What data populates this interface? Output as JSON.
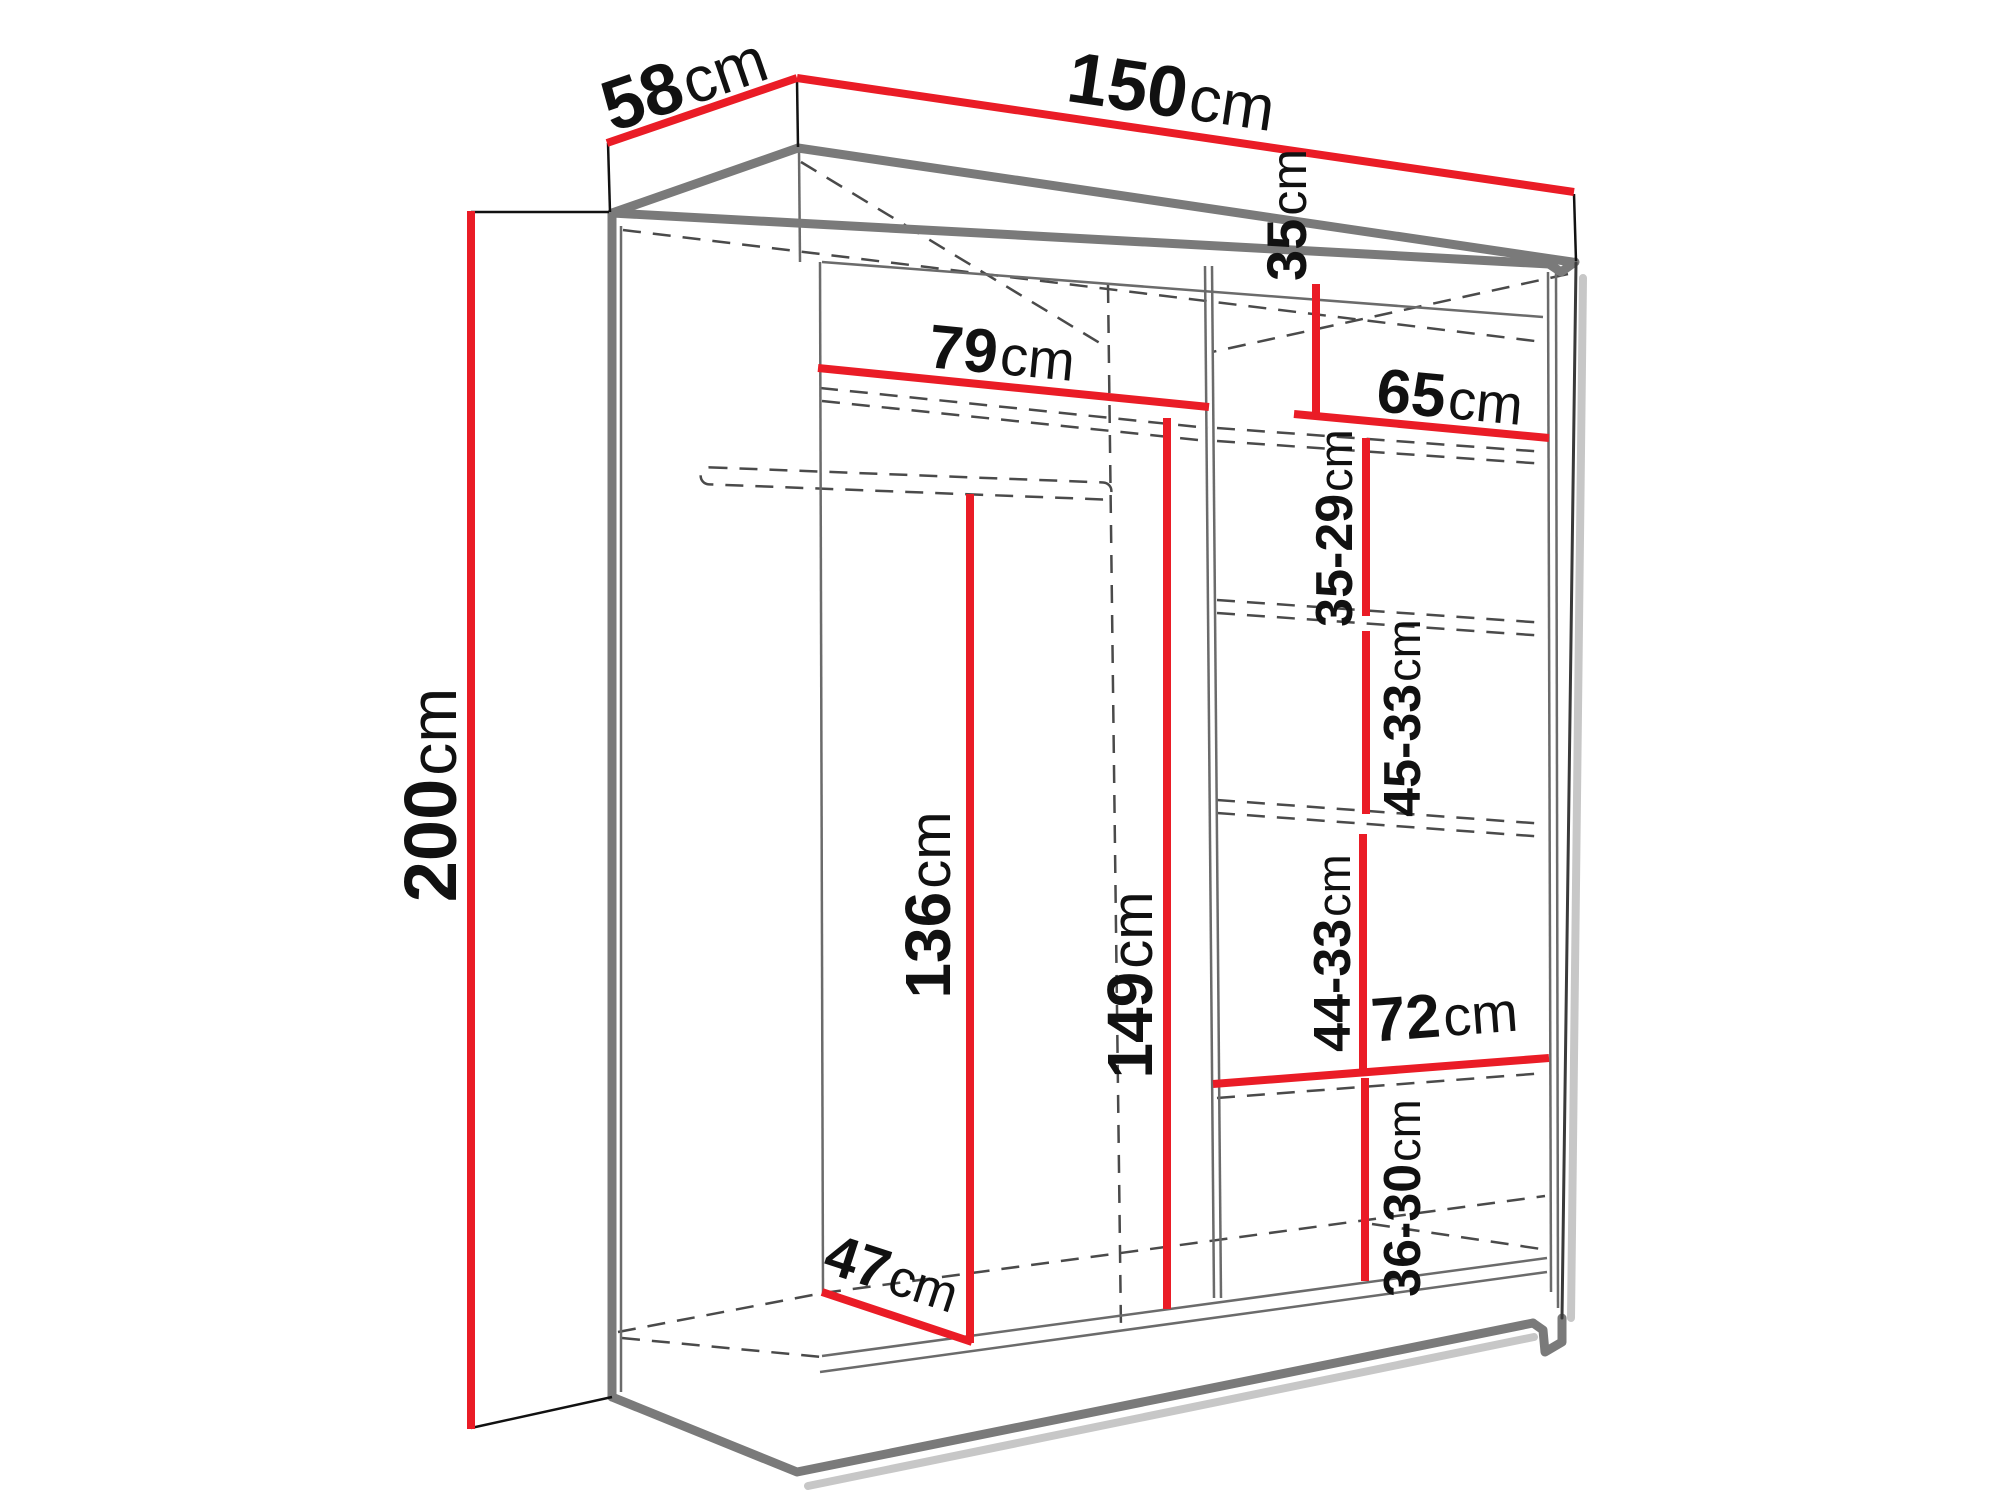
{
  "diagram": {
    "title": "wardrobe dimension diagram",
    "colors": {
      "dimension_line": "#ea1c26",
      "outline": "#7a7a7a",
      "hidden_edge": "#4a4a4a",
      "text": "#111111",
      "background": "#ffffff"
    },
    "dimensions": {
      "width": {
        "value": "150",
        "unit": "cm"
      },
      "depth": {
        "value": "58",
        "unit": "cm"
      },
      "height": {
        "value": "200",
        "unit": "cm"
      },
      "left_width": {
        "value": "79",
        "unit": "cm"
      },
      "top_gap": {
        "value": "35",
        "unit": "cm"
      },
      "right_width": {
        "value": "65",
        "unit": "cm"
      },
      "gap1": {
        "value": "35-29",
        "unit": "cm"
      },
      "gap2": {
        "value": "45-33",
        "unit": "cm"
      },
      "gap3": {
        "value": "44-33",
        "unit": "cm"
      },
      "bottom_width": {
        "value": "72",
        "unit": "cm"
      },
      "gap4": {
        "value": "36-30",
        "unit": "cm"
      },
      "left_height": {
        "value": "136",
        "unit": "cm"
      },
      "right_height": {
        "value": "149",
        "unit": "cm"
      },
      "floor_depth": {
        "value": "47",
        "unit": "cm"
      }
    }
  }
}
